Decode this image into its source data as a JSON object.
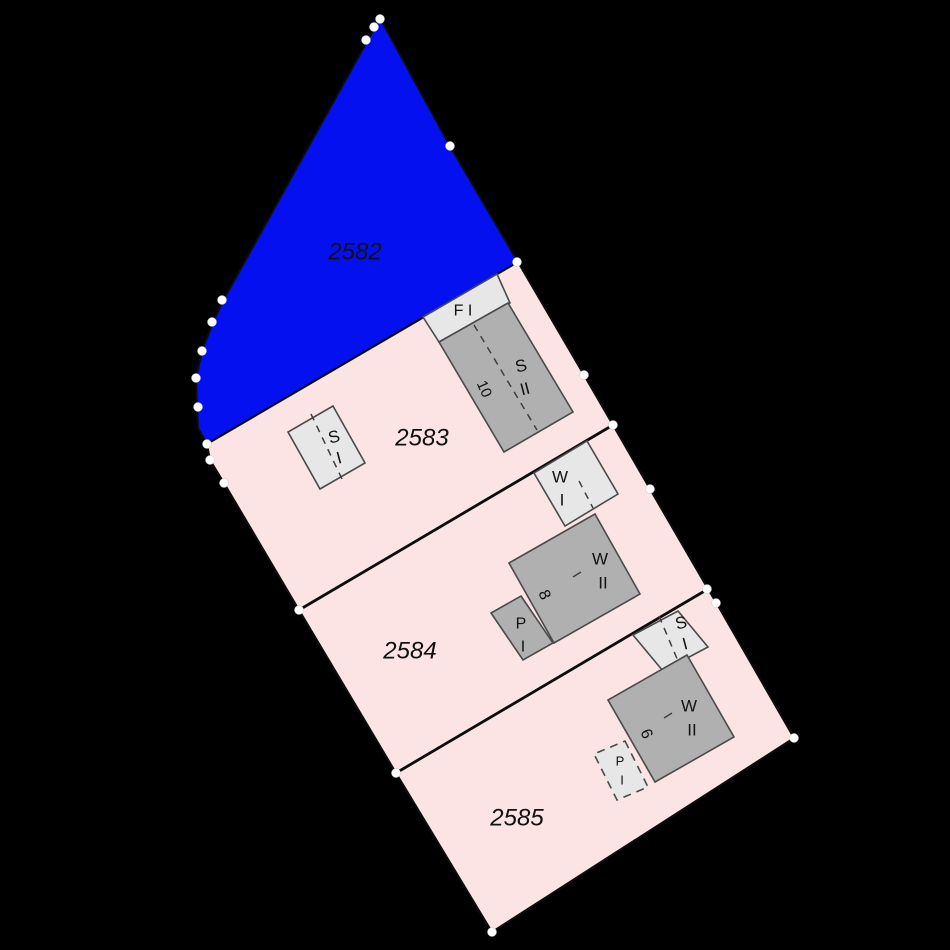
{
  "map": {
    "colors": {
      "background": "#000000",
      "parcel_selected_fill": "#0510f0",
      "parcel_fill": "#fce4e5",
      "building_light_fill": "#e7e7e7",
      "building_dark_fill": "#b0b0b0",
      "building_stroke": "#4a4a4a",
      "boundary_stroke": "#0d0d0d",
      "ridge_stroke": "#3f3f3f",
      "survey_point_fill": "#ffffff",
      "label_color": "#111111"
    },
    "parcels": [
      {
        "number": "2582",
        "selected": true,
        "label_x": 355,
        "label_y": 252,
        "points": "380,18 450,146 518,262 207,444 198,428 197,407 196,378 202,351 213,322 224,299"
      },
      {
        "number": "2583",
        "selected": false,
        "label_x": 422,
        "label_y": 438,
        "points": "518,262 584,375 613,425 299,610 224,483 210,460 207,444"
      },
      {
        "number": "2584",
        "selected": false,
        "label_x": 410,
        "label_y": 651,
        "points": "613,425 650,489 708,589 396,773 299,610"
      },
      {
        "number": "2585",
        "selected": false,
        "label_x": 517,
        "label_y": 818,
        "points": "708,589 717,604 794,738 492,932 396,773"
      }
    ],
    "boundaries": [
      {
        "x1": 299,
        "y1": 610,
        "x2": 613,
        "y2": 425
      },
      {
        "x1": 396,
        "y1": 773,
        "x2": 708,
        "y2": 589
      }
    ],
    "buildings": [
      {
        "use": "F I",
        "style": "light",
        "dashed": false,
        "points": "423,317 497,274 510,303 439,342",
        "ridges": [],
        "ticks": [],
        "labels": [
          {
            "text": "F I",
            "x": 463,
            "y": 311,
            "rot": 0,
            "size": 16
          }
        ]
      },
      {
        "use": "S II",
        "style": "dark",
        "dashed": false,
        "points": "439,342 508,303 573,412 504,452",
        "ridges": [
          [
            474,
            325,
            537,
            430
          ]
        ],
        "ticks": [],
        "labels": [
          {
            "text": "S",
            "x": 521,
            "y": 366,
            "rot": -15,
            "size": 17
          },
          {
            "text": "II",
            "x": 525,
            "y": 389,
            "rot": -15,
            "size": 17
          },
          {
            "text": "10",
            "x": 484,
            "y": 389,
            "rot": 66,
            "size": 15
          }
        ]
      },
      {
        "use": "S I",
        "style": "light",
        "dashed": false,
        "points": "333,406 365,463 320,489 288,432",
        "ridges": [
          [
            311,
            414,
            343,
            481
          ]
        ],
        "ticks": [],
        "labels": [
          {
            "text": "S",
            "x": 334,
            "y": 437,
            "rot": -15,
            "size": 17
          },
          {
            "text": "I",
            "x": 339,
            "y": 458,
            "rot": -15,
            "size": 17
          }
        ]
      },
      {
        "use": "W I",
        "style": "light",
        "dashed": false,
        "points": "587,441 618,494 565,526 534,473",
        "ridges": [
          [
            579,
            481,
            593,
            508
          ]
        ],
        "ticks": [],
        "labels": [
          {
            "text": "W",
            "x": 560,
            "y": 477,
            "rot": 0,
            "size": 17
          },
          {
            "text": "I",
            "x": 562,
            "y": 500,
            "rot": 0,
            "size": 17
          }
        ]
      },
      {
        "use": "P I",
        "style": "dark",
        "dashed": false,
        "points": "521,596 553,643 523,660 491,613",
        "ridges": [],
        "ticks": [],
        "labels": [
          {
            "text": "P",
            "x": 521,
            "y": 624,
            "rot": 0,
            "size": 16
          },
          {
            "text": "I",
            "x": 523,
            "y": 647,
            "rot": 0,
            "size": 16
          }
        ]
      },
      {
        "use": "W II",
        "style": "dark",
        "dashed": false,
        "points": "595,514 640,594 554,643 509,563",
        "ridges": [],
        "ticks": [
          [
            573,
            577,
            581,
            572
          ]
        ],
        "labels": [
          {
            "text": "W",
            "x": 600,
            "y": 559,
            "rot": 0,
            "size": 17
          },
          {
            "text": "II",
            "x": 603,
            "y": 583,
            "rot": 0,
            "size": 17
          },
          {
            "text": "8",
            "x": 544,
            "y": 595,
            "rot": 66,
            "size": 16
          }
        ]
      },
      {
        "use": "S I",
        "style": "light",
        "dashed": false,
        "points": "678,611 708,647 663,671 633,635",
        "ridges": [
          [
            659,
            616,
            678,
            661
          ]
        ],
        "ticks": [],
        "labels": [
          {
            "text": "S",
            "x": 681,
            "y": 623,
            "rot": -15,
            "size": 17
          },
          {
            "text": "I",
            "x": 685,
            "y": 644,
            "rot": -15,
            "size": 17
          }
        ]
      },
      {
        "use": "P I",
        "style": "light",
        "dashed": true,
        "points": "625,741 648,787 617,800 594,754",
        "ridges": [],
        "ticks": [],
        "labels": [
          {
            "text": "P",
            "x": 620,
            "y": 761,
            "rot": 0,
            "size": 13
          },
          {
            "text": "I",
            "x": 622,
            "y": 780,
            "rot": 0,
            "size": 13
          }
        ]
      },
      {
        "use": "W II",
        "style": "dark",
        "dashed": false,
        "points": "687,655 734,737 655,782 608,700",
        "ridges": [],
        "ticks": [
          [
            664,
            718,
            672,
            713
          ]
        ],
        "labels": [
          {
            "text": "W",
            "x": 689,
            "y": 706,
            "rot": 0,
            "size": 17
          },
          {
            "text": "II",
            "x": 692,
            "y": 730,
            "rot": 0,
            "size": 17
          },
          {
            "text": "6",
            "x": 646,
            "y": 734,
            "rot": 66,
            "size": 16
          }
        ]
      }
    ],
    "survey_points": [
      [
        380,
        19
      ],
      [
        374,
        27
      ],
      [
        366,
        40
      ],
      [
        450,
        146
      ],
      [
        517,
        262
      ],
      [
        584,
        375
      ],
      [
        613,
        425
      ],
      [
        650,
        489
      ],
      [
        707,
        589
      ],
      [
        716,
        603
      ],
      [
        794,
        738
      ],
      [
        492,
        932
      ],
      [
        396,
        773
      ],
      [
        299,
        610
      ],
      [
        224,
        483
      ],
      [
        210,
        460
      ],
      [
        207,
        444
      ],
      [
        198,
        407
      ],
      [
        196,
        378
      ],
      [
        202,
        351
      ],
      [
        212,
        322
      ],
      [
        222,
        300
      ]
    ]
  }
}
